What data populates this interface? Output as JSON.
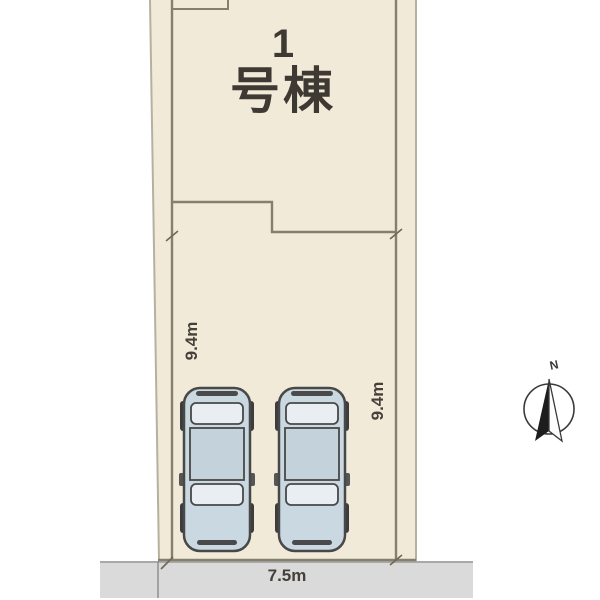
{
  "plot": {
    "building_number": "1",
    "building_suffix": "号棟"
  },
  "dimensions": {
    "left_depth": "9.4m",
    "right_depth": "9.4m",
    "frontage": "7.5m"
  },
  "compass": {
    "north_label": "N"
  },
  "colors": {
    "parcel_fill": "#f1ead9",
    "plot_line": "#85806c",
    "outer_line": "#b5b1a1",
    "road_fill": "#d9dad9",
    "road_edge": "#a9a9a9",
    "car_body": "#cad8e1",
    "car_window": "#e9eef2",
    "car_roof": "#c4d2dc",
    "car_wheel": "#3c3c3c",
    "text": "#3e3933"
  }
}
